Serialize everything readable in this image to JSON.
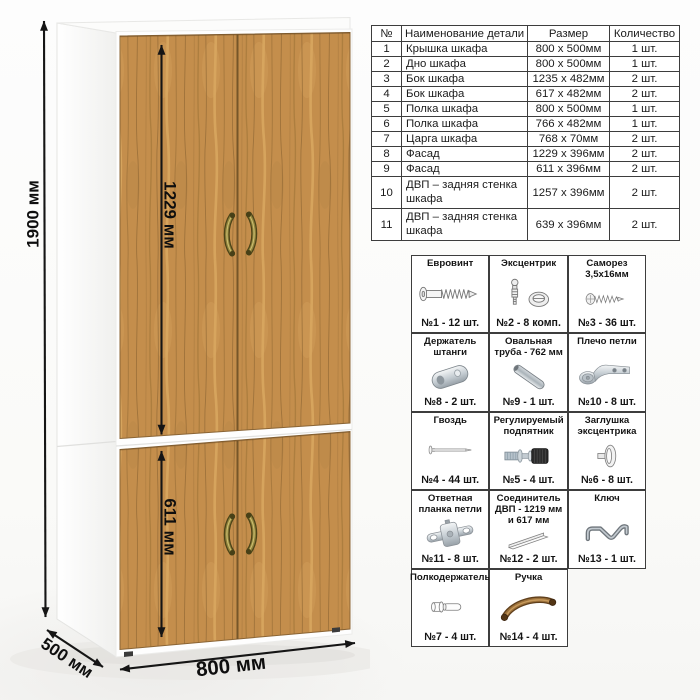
{
  "dimensions": {
    "height": "1900 мм",
    "upper_door": "1229 мм",
    "lower_door": "611 мм",
    "width": "800 мм",
    "depth": "500 мм"
  },
  "parts_table": {
    "headers": [
      "№",
      "Наименование детали",
      "Размер",
      "Количество"
    ],
    "rows": [
      [
        "1",
        "Крышка шкафа",
        "800 x 500мм",
        "1 шт."
      ],
      [
        "2",
        "Дно шкафа",
        "800 x 500мм",
        "1 шт."
      ],
      [
        "3",
        "Бок шкафа",
        "1235 x 482мм",
        "2 шт."
      ],
      [
        "4",
        "Бок шкафа",
        "617 x 482мм",
        "2 шт."
      ],
      [
        "5",
        "Полка шкафа",
        "800 x 500мм",
        "1 шт."
      ],
      [
        "6",
        "Полка шкафа",
        "766 x 482мм",
        "1 шт."
      ],
      [
        "7",
        "Царга шкафа",
        "768 x 70мм",
        "2 шт."
      ],
      [
        "8",
        "Фасад",
        "1229 x 396мм",
        "2 шт."
      ],
      [
        "9",
        "Фасад",
        "611 x 396мм",
        "2 шт."
      ],
      [
        "10",
        "ДВП – задняя стенка шкафа",
        "1257 x 396мм",
        "2 шт."
      ],
      [
        "11",
        "ДВП – задняя стенка шкафа",
        "639 x 396мм",
        "2 шт."
      ]
    ]
  },
  "hardware": {
    "items": [
      {
        "name": "Евровинт",
        "count": "№1 - 12 шт.",
        "icon": "euro-screw"
      },
      {
        "name": "Эксцентрик",
        "count": "№2 - 8 комп.",
        "icon": "eccentric-cam"
      },
      {
        "name": "Саморез 3,5х16мм",
        "count": "№3 - 36 шт.",
        "icon": "tapping-screw"
      },
      {
        "name": "Держатель штанги",
        "count": "№8 - 2 шт.",
        "icon": "rod-holder"
      },
      {
        "name": "Овальная труба - 762 мм",
        "count": "№9 - 1 шт.",
        "icon": "oval-tube"
      },
      {
        "name": "Плечо петли",
        "count": "№10 - 8 шт.",
        "icon": "hinge-arm"
      },
      {
        "name": "Гвоздь",
        "count": "№4 - 44 шт.",
        "icon": "nail"
      },
      {
        "name": "Регулируемый подпятник",
        "count": "№5 - 4 шт.",
        "icon": "adjustable-foot"
      },
      {
        "name": "Заглушка эксцентрика",
        "count": "№6 - 8 шт.",
        "icon": "cam-cap"
      },
      {
        "name": "Ответная планка петли",
        "count": "№11 - 8 шт.",
        "icon": "hinge-plate"
      },
      {
        "name": "Соединитель ДВП - 1219 мм и 617 мм",
        "count": "№12 - 2 шт.",
        "icon": "hdf-connector"
      },
      {
        "name": "Ключ",
        "count": "№13 - 1 шт.",
        "icon": "hex-key"
      },
      {
        "name": "Полкодержатель",
        "count": "№7 - 4 шт.",
        "icon": "shelf-pin"
      },
      {
        "name": "Ручка",
        "count": "№14 - 4 шт.",
        "icon": "handle"
      }
    ]
  },
  "colors": {
    "wood_mid": "#c48e4c",
    "wood_light": "#d9a760",
    "wood_dark": "#8f6733",
    "handle_brass": "#8f813a",
    "carcass_white": "#ffffff",
    "dimension_line": "#151515",
    "table_border": "#3d3d3d"
  }
}
